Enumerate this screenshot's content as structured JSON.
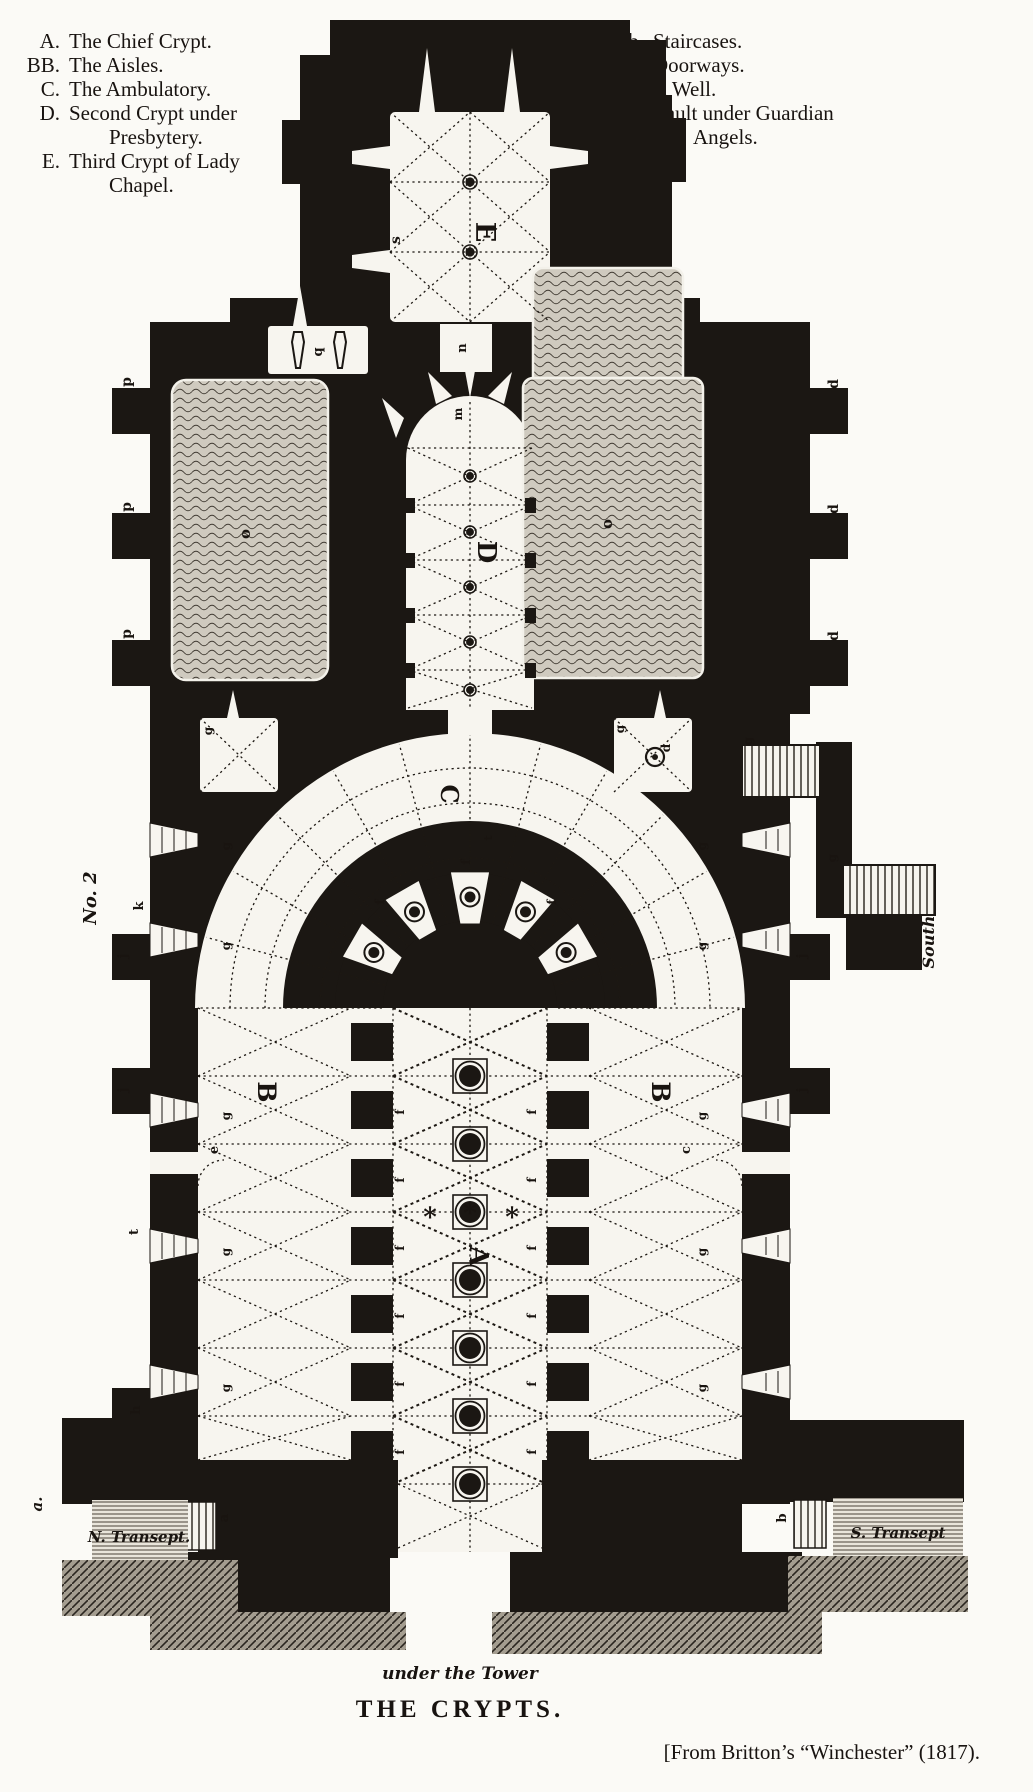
{
  "legend_left": {
    "items": [
      {
        "key": "A.",
        "lines": [
          "The Chief Crypt."
        ]
      },
      {
        "key": "BB.",
        "lines": [
          "The Aisles."
        ]
      },
      {
        "key": "C.",
        "lines": [
          "The Ambulatory."
        ]
      },
      {
        "key": "D.",
        "lines": [
          "Second Crypt under",
          "Presbytery."
        ]
      },
      {
        "key": "E.",
        "lines": [
          "Third Crypt of Lady",
          "Chapel."
        ]
      }
    ]
  },
  "legend_right": {
    "items": [
      {
        "key": "ab.",
        "lines": [
          "Staircases."
        ]
      },
      {
        "key": "ce.",
        "lines": [
          "Doorways."
        ]
      },
      {
        "key": "d.",
        "lines": [
          "A Well."
        ]
      },
      {
        "key": "q.",
        "lines": [
          "Vault under Guardian",
          "Angels."
        ]
      }
    ]
  },
  "captions": {
    "under_tower": "under the Tower",
    "title": "THE CRYPTS.",
    "source": "[From Britton’s “Winchester” (1817)."
  },
  "plan": {
    "figure_number": "No. 2",
    "colors": {
      "ink": "#1b1713",
      "paper": "#fbfaf6",
      "room": "#f7f5ef"
    },
    "labels": [
      {
        "text": "E",
        "x": 476,
        "y": 232,
        "rot": 90,
        "size": 27,
        "cls": "cap"
      },
      {
        "text": "D",
        "x": 478,
        "y": 552,
        "rot": 90,
        "size": 26,
        "cls": "cap"
      },
      {
        "text": "C",
        "x": 441,
        "y": 794,
        "rot": 90,
        "size": 24,
        "cls": "cap"
      },
      {
        "text": "A",
        "x": 470,
        "y": 1256,
        "rot": 90,
        "size": 26,
        "cls": "cap"
      },
      {
        "text": "B",
        "x": 258,
        "y": 1092,
        "rot": 90,
        "size": 25,
        "cls": "cap"
      },
      {
        "text": "B",
        "x": 652,
        "y": 1092,
        "rot": 90,
        "size": 25,
        "cls": "cap"
      },
      {
        "text": "s",
        "x": 400,
        "y": 240,
        "rot": -90,
        "size": 14,
        "cls": "sm"
      },
      {
        "text": "m",
        "x": 462,
        "y": 414,
        "rot": -90,
        "size": 12,
        "cls": "sm"
      },
      {
        "text": "n",
        "x": 466,
        "y": 348,
        "rot": -90,
        "size": 13,
        "cls": "sm"
      },
      {
        "text": "q",
        "x": 322,
        "y": 352,
        "rot": -90,
        "size": 13,
        "cls": "sm"
      },
      {
        "text": "o",
        "x": 250,
        "y": 534,
        "rot": -90,
        "size": 15,
        "cls": "sm"
      },
      {
        "text": "o",
        "x": 612,
        "y": 524,
        "rot": -90,
        "size": 15,
        "cls": "sm"
      },
      {
        "text": "p",
        "x": 131,
        "y": 382,
        "rot": -90,
        "size": 14,
        "cls": "sm"
      },
      {
        "text": "p",
        "x": 131,
        "y": 507,
        "rot": -90,
        "size": 14,
        "cls": "sm"
      },
      {
        "text": "p",
        "x": 131,
        "y": 634,
        "rot": -90,
        "size": 14,
        "cls": "sm"
      },
      {
        "text": "d",
        "x": 838,
        "y": 384,
        "rot": -90,
        "size": 14,
        "cls": "sm"
      },
      {
        "text": "d",
        "x": 838,
        "y": 509,
        "rot": -90,
        "size": 14,
        "cls": "sm"
      },
      {
        "text": "d",
        "x": 838,
        "y": 636,
        "rot": -90,
        "size": 14,
        "cls": "sm"
      },
      {
        "text": "k",
        "x": 143,
        "y": 906,
        "rot": -90,
        "size": 13,
        "cls": "sm"
      },
      {
        "text": "j",
        "x": 127,
        "y": 956,
        "rot": -90,
        "size": 13,
        "cls": "sm"
      },
      {
        "text": "j",
        "x": 127,
        "y": 1090,
        "rot": -90,
        "size": 13,
        "cls": "sm"
      },
      {
        "text": "t",
        "x": 138,
        "y": 1232,
        "rot": -90,
        "size": 13,
        "cls": "sm"
      },
      {
        "text": "h",
        "x": 140,
        "y": 1410,
        "rot": -90,
        "size": 13,
        "cls": "sm"
      },
      {
        "text": "j",
        "x": 806,
        "y": 956,
        "rot": -90,
        "size": 13,
        "cls": "sm"
      },
      {
        "text": "j",
        "x": 806,
        "y": 1090,
        "rot": -90,
        "size": 13,
        "cls": "sm"
      },
      {
        "text": "g",
        "x": 212,
        "y": 731,
        "rot": -90,
        "size": 12,
        "cls": "sm"
      },
      {
        "text": "g",
        "x": 624,
        "y": 729,
        "rot": -90,
        "size": 12,
        "cls": "sm"
      },
      {
        "text": "g",
        "x": 752,
        "y": 741,
        "rot": -90,
        "size": 12,
        "cls": "sm"
      },
      {
        "text": "g",
        "x": 836,
        "y": 858,
        "rot": -90,
        "size": 12,
        "cls": "sm"
      },
      {
        "text": "d",
        "x": 670,
        "y": 748,
        "rot": -90,
        "size": 12,
        "cls": "sm"
      },
      {
        "text": "g",
        "x": 230,
        "y": 846,
        "rot": -90,
        "size": 12,
        "cls": "sm"
      },
      {
        "text": "g",
        "x": 230,
        "y": 946,
        "rot": -90,
        "size": 12,
        "cls": "sm"
      },
      {
        "text": "g",
        "x": 230,
        "y": 1116,
        "rot": -90,
        "size": 12,
        "cls": "sm"
      },
      {
        "text": "g",
        "x": 230,
        "y": 1252,
        "rot": -90,
        "size": 12,
        "cls": "sm"
      },
      {
        "text": "g",
        "x": 230,
        "y": 1388,
        "rot": -90,
        "size": 12,
        "cls": "sm"
      },
      {
        "text": "g",
        "x": 706,
        "y": 846,
        "rot": -90,
        "size": 12,
        "cls": "sm"
      },
      {
        "text": "g",
        "x": 706,
        "y": 946,
        "rot": -90,
        "size": 12,
        "cls": "sm"
      },
      {
        "text": "g",
        "x": 706,
        "y": 1116,
        "rot": -90,
        "size": 12,
        "cls": "sm"
      },
      {
        "text": "g",
        "x": 706,
        "y": 1252,
        "rot": -90,
        "size": 12,
        "cls": "sm"
      },
      {
        "text": "g",
        "x": 706,
        "y": 1388,
        "rot": -90,
        "size": 12,
        "cls": "sm"
      },
      {
        "text": "e",
        "x": 218,
        "y": 1150,
        "rot": -90,
        "size": 13,
        "cls": "sm"
      },
      {
        "text": "c",
        "x": 690,
        "y": 1150,
        "rot": -90,
        "size": 13,
        "cls": "sm"
      },
      {
        "text": "a",
        "x": 228,
        "y": 1518,
        "rot": -90,
        "size": 13,
        "cls": "sm"
      },
      {
        "text": "b",
        "x": 786,
        "y": 1518,
        "rot": -90,
        "size": 13,
        "cls": "sm"
      },
      {
        "text": "t",
        "x": 492,
        "y": 838,
        "rot": -90,
        "size": 11,
        "cls": "sm"
      },
      {
        "text": "f",
        "x": 384,
        "y": 902,
        "rot": -90,
        "size": 12,
        "cls": "sm"
      },
      {
        "text": "f",
        "x": 470,
        "y": 862,
        "rot": -90,
        "size": 12,
        "cls": "sm"
      },
      {
        "text": "f",
        "x": 556,
        "y": 902,
        "rot": -90,
        "size": 12,
        "cls": "sm"
      },
      {
        "text": "f",
        "x": 404,
        "y": 1112,
        "rot": -90,
        "size": 12,
        "cls": "sm"
      },
      {
        "text": "f",
        "x": 404,
        "y": 1180,
        "rot": -90,
        "size": 12,
        "cls": "sm"
      },
      {
        "text": "f",
        "x": 404,
        "y": 1248,
        "rot": -90,
        "size": 12,
        "cls": "sm"
      },
      {
        "text": "f",
        "x": 404,
        "y": 1316,
        "rot": -90,
        "size": 12,
        "cls": "sm"
      },
      {
        "text": "f",
        "x": 404,
        "y": 1384,
        "rot": -90,
        "size": 12,
        "cls": "sm"
      },
      {
        "text": "f",
        "x": 404,
        "y": 1452,
        "rot": -90,
        "size": 12,
        "cls": "sm"
      },
      {
        "text": "f",
        "x": 536,
        "y": 1112,
        "rot": -90,
        "size": 12,
        "cls": "sm"
      },
      {
        "text": "f",
        "x": 536,
        "y": 1180,
        "rot": -90,
        "size": 12,
        "cls": "sm"
      },
      {
        "text": "f",
        "x": 536,
        "y": 1248,
        "rot": -90,
        "size": 12,
        "cls": "sm"
      },
      {
        "text": "f",
        "x": 536,
        "y": 1316,
        "rot": -90,
        "size": 12,
        "cls": "sm"
      },
      {
        "text": "f",
        "x": 536,
        "y": 1384,
        "rot": -90,
        "size": 12,
        "cls": "sm"
      },
      {
        "text": "f",
        "x": 536,
        "y": 1452,
        "rot": -90,
        "size": 12,
        "cls": "sm"
      },
      {
        "text": "*",
        "x": 430,
        "y": 1226,
        "rot": 0,
        "size": 26,
        "cls": "ast"
      },
      {
        "text": "*",
        "x": 470,
        "y": 1222,
        "rot": 0,
        "size": 26,
        "cls": "ast"
      },
      {
        "text": "*",
        "x": 512,
        "y": 1226,
        "rot": 0,
        "size": 26,
        "cls": "ast"
      },
      {
        "text": "No. 2",
        "x": 96,
        "y": 898,
        "rot": -90,
        "size": 18,
        "cls": "fig"
      },
      {
        "text": "a.",
        "x": 42,
        "y": 1504,
        "rot": -90,
        "size": 15,
        "cls": "script"
      },
      {
        "text": "South",
        "x": 934,
        "y": 942,
        "rot": -90,
        "size": 16,
        "cls": "script"
      },
      {
        "text": "N. Transept.",
        "x": 139,
        "y": 1542,
        "rot": 0,
        "size": 15,
        "cls": "script"
      },
      {
        "text": "S. Transept",
        "x": 898,
        "y": 1538,
        "rot": 0,
        "size": 15,
        "cls": "script"
      }
    ]
  }
}
